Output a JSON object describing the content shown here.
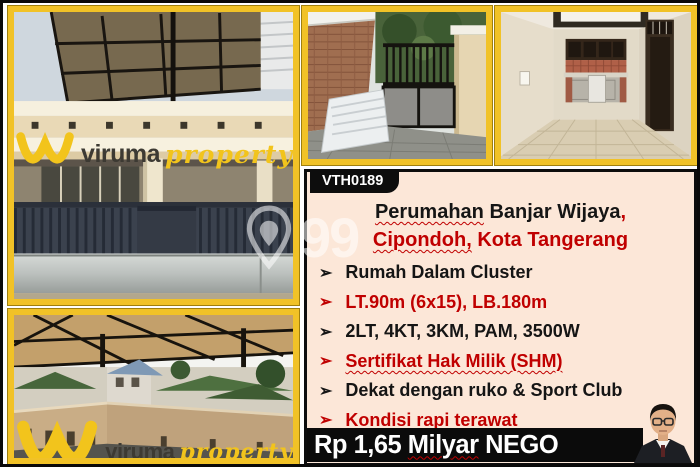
{
  "branding": {
    "watermark_brand": "viruma",
    "watermark_suffix": "property",
    "photo_watermark": "99"
  },
  "panel": {
    "code": "VTH0189",
    "title_word1": "Perumahan",
    "title_rest1": " Banjar Wijaya",
    "title_comma": ",",
    "title_word2": "Cipondoh,",
    "title_rest2": " Kota Tangerang",
    "bullet": "➢",
    "features": [
      {
        "text": "Rumah Dalam Cluster",
        "color": "black"
      },
      {
        "text": "LT.90m (6x15), LB.180m",
        "color": "red"
      },
      {
        "text": "2LT, 4KT, 3KM, PAM, 3500W",
        "color": "black"
      },
      {
        "text": "Sertifikat Hak Milik (SHM)",
        "color": "red"
      },
      {
        "text": "Dekat dengan ruko & Sport Club",
        "color": "black"
      },
      {
        "text": "Kondisi rapi terawat",
        "color": "red"
      }
    ],
    "price_prefix": "Rp 1,65 ",
    "price_unit": "Milyar",
    "price_suffix": " NEGO"
  },
  "colors": {
    "accent_red": "#C00000",
    "frame_gold": "#F1C227",
    "panel_background": "#FCE7D8",
    "price_bar_background": "#0B0B0B",
    "watermark_yellow": "#F2C41C"
  }
}
